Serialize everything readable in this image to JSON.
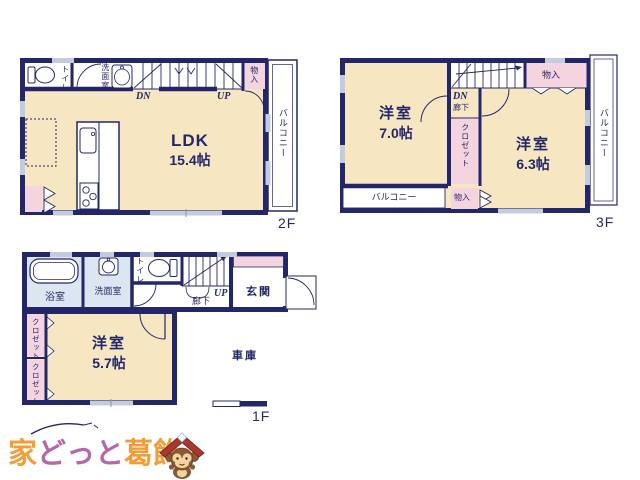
{
  "colors": {
    "wall_navy": "#23276a",
    "room_cream": "#f6e7c2",
    "closet_pink": "#f4d4de",
    "wet_blue": "#dce6f1",
    "window_gray": "#c3cbdc",
    "logo_orange": "#f29d35",
    "logo_purple": "#b468a8",
    "mascot_roof_red": "#a8392c"
  },
  "floor_2f": {
    "floor_label": "2F",
    "ldk": "LDK",
    "ldk_size": "15.4帖",
    "toilet": "トイレ",
    "washroom": "洗面室",
    "storage": "物入",
    "balcony": "バルコニー",
    "stairs_down": "DN",
    "stairs_up": "UP"
  },
  "floor_3f": {
    "floor_label": "3F",
    "room_a": "洋室",
    "room_a_size": "7.0帖",
    "room_b": "洋室",
    "room_b_size": "6.3帖",
    "stairs_down": "DN",
    "hallway": "廊下",
    "storage_top": "物入",
    "storage_bottom": "物入",
    "closet": "クロゼット",
    "balcony_bottom": "バルコニー",
    "balcony_right": "バルコニー"
  },
  "floor_1f": {
    "floor_label": "1F",
    "bathroom": "浴室",
    "washroom": "洗面室",
    "toilet": "トイレ",
    "hallway": "廊下",
    "stairs_up": "UP",
    "entrance": "玄関",
    "closet_upper": "クロゼット",
    "closet_lower": "クロゼット",
    "room": "洋室",
    "room_size": "5.7帖",
    "garage": "車庫"
  },
  "logo": {
    "text_1": "家",
    "text_2": "どっと",
    "text_3": "葛飾"
  }
}
